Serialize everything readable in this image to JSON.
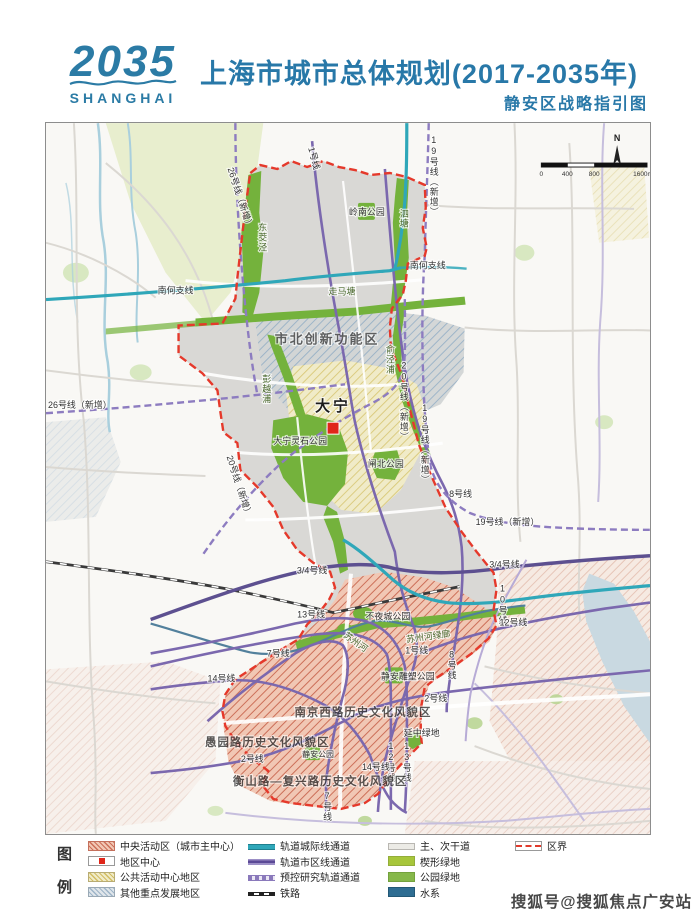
{
  "header": {
    "logo_year": "2035",
    "logo_city": "SHANGHAI",
    "title": "上海市城市总体规划(2017-2035年)",
    "subtitle": "静安区战略指引图"
  },
  "map": {
    "scale": {
      "north": "N",
      "ticks": [
        "0",
        "400",
        "800",
        "1600m"
      ]
    },
    "labels": [
      {
        "t": "26号线（新增）",
        "x": 192,
        "y": 76,
        "rot": 72
      },
      {
        "t": "1号线",
        "x": 266,
        "y": 36,
        "rot": 75
      },
      {
        "t": "19号线（新增）",
        "x": 389,
        "y": 12,
        "vert": true
      },
      {
        "t": "泗塘",
        "x": 359,
        "y": 86,
        "vert": true,
        "cls": "river"
      },
      {
        "t": "东茭泾",
        "x": 217,
        "y": 100,
        "vert": true,
        "cls": "river"
      },
      {
        "t": "岭南公园",
        "x": 322,
        "y": 92
      },
      {
        "t": "南何支线",
        "x": 130,
        "y": 171
      },
      {
        "t": "南何支线",
        "x": 383,
        "y": 146
      },
      {
        "t": "走马塘",
        "x": 297,
        "y": 172,
        "cls": "river"
      },
      {
        "t": "市北创新功能区",
        "x": 282,
        "y": 221,
        "cls": "zone"
      },
      {
        "t": "彭越浦",
        "x": 221,
        "y": 252,
        "vert": true,
        "cls": "river"
      },
      {
        "t": "俞泾浦",
        "x": 345,
        "y": 222,
        "vert": true,
        "cls": "river"
      },
      {
        "t": "20号线（新增）",
        "x": 359,
        "y": 238,
        "vert": true
      },
      {
        "t": "26号线（新增）",
        "x": 34,
        "y": 286
      },
      {
        "t": "大宁",
        "x": 288,
        "y": 289,
        "cls": "big"
      },
      {
        "t": "大宁灵石公园",
        "x": 255,
        "y": 322
      },
      {
        "t": "20号线（新增）",
        "x": 191,
        "y": 365,
        "rot": 72
      },
      {
        "t": "19号线（新增）",
        "x": 380,
        "y": 281,
        "vert": true
      },
      {
        "t": "闸北公园",
        "x": 341,
        "y": 345
      },
      {
        "t": "8号线",
        "x": 416,
        "y": 375
      },
      {
        "t": "19号线（新增）",
        "x": 463,
        "y": 403
      },
      {
        "t": "3/4号线",
        "x": 460,
        "y": 446
      },
      {
        "t": "3/4号线",
        "x": 267,
        "y": 452
      },
      {
        "t": "10号线",
        "x": 458,
        "y": 462,
        "vert": true
      },
      {
        "t": "13号线",
        "x": 266,
        "y": 496
      },
      {
        "t": "12号线",
        "x": 469,
        "y": 504
      },
      {
        "t": "不夜城公园",
        "x": 343,
        "y": 498
      },
      {
        "t": "苏州河",
        "x": 309,
        "y": 523,
        "rot": 35,
        "cls": "river"
      },
      {
        "t": "苏州河绿廊",
        "x": 384,
        "y": 518,
        "rot": -8,
        "cls": "river"
      },
      {
        "t": "1号线",
        "x": 372,
        "y": 532
      },
      {
        "t": "8号线",
        "x": 407,
        "y": 528,
        "vert": true
      },
      {
        "t": "7号线",
        "x": 233,
        "y": 535
      },
      {
        "t": "14号线",
        "x": 176,
        "y": 560
      },
      {
        "t": "静安雕塑公园",
        "x": 363,
        "y": 558
      },
      {
        "t": "2号线",
        "x": 391,
        "y": 580
      },
      {
        "t": "南京西路历史文化风貌区",
        "x": 318,
        "y": 595,
        "cls": "zone2"
      },
      {
        "t": "延中绿地",
        "x": 377,
        "y": 615
      },
      {
        "t": "愚园路历史文化风貌区",
        "x": 222,
        "y": 625,
        "cls": "zone2"
      },
      {
        "t": "2号线",
        "x": 207,
        "y": 641
      },
      {
        "t": "静安公园",
        "x": 273,
        "y": 636,
        "cls": "small"
      },
      {
        "t": "12号线",
        "x": 346,
        "y": 620,
        "vert": true
      },
      {
        "t": "13号线",
        "x": 362,
        "y": 620,
        "vert": true
      },
      {
        "t": "14号线",
        "x": 331,
        "y": 649
      },
      {
        "t": "衡山路—复兴路历史文化风貌区",
        "x": 275,
        "y": 664,
        "cls": "zone2"
      },
      {
        "t": "7号线",
        "x": 282,
        "y": 670,
        "vert": true
      }
    ]
  },
  "legend": {
    "title_chars": [
      "图",
      "例"
    ],
    "areas": [
      {
        "label": "中央活动区（城市主中心）"
      },
      {
        "label": "地区中心"
      },
      {
        "label": "公共活动中心地区"
      },
      {
        "label": "其他重点发展地区"
      }
    ],
    "lines": [
      {
        "label": "轨道城际线通道"
      },
      {
        "label": "轨道市区线通道"
      },
      {
        "label": "预控研究轨道通道"
      },
      {
        "label": "铁路"
      }
    ],
    "fills": [
      {
        "label": "主、次干道"
      },
      {
        "label": "楔形绿地"
      },
      {
        "label": "公园绿地"
      },
      {
        "label": "水系"
      }
    ],
    "boundary": [
      {
        "label": "区界"
      }
    ]
  },
  "watermark": "搜狐号@搜狐焦点广安站",
  "colors": {
    "accent_teal": "#2878a8",
    "district_boundary": "#e5392b",
    "metro_purple": "#7b68ae",
    "intercity_teal": "#2fa7b9",
    "park_green": "#86b84a",
    "wedge_green": "#a7c63b",
    "water_blue": "#2e6d92"
  }
}
